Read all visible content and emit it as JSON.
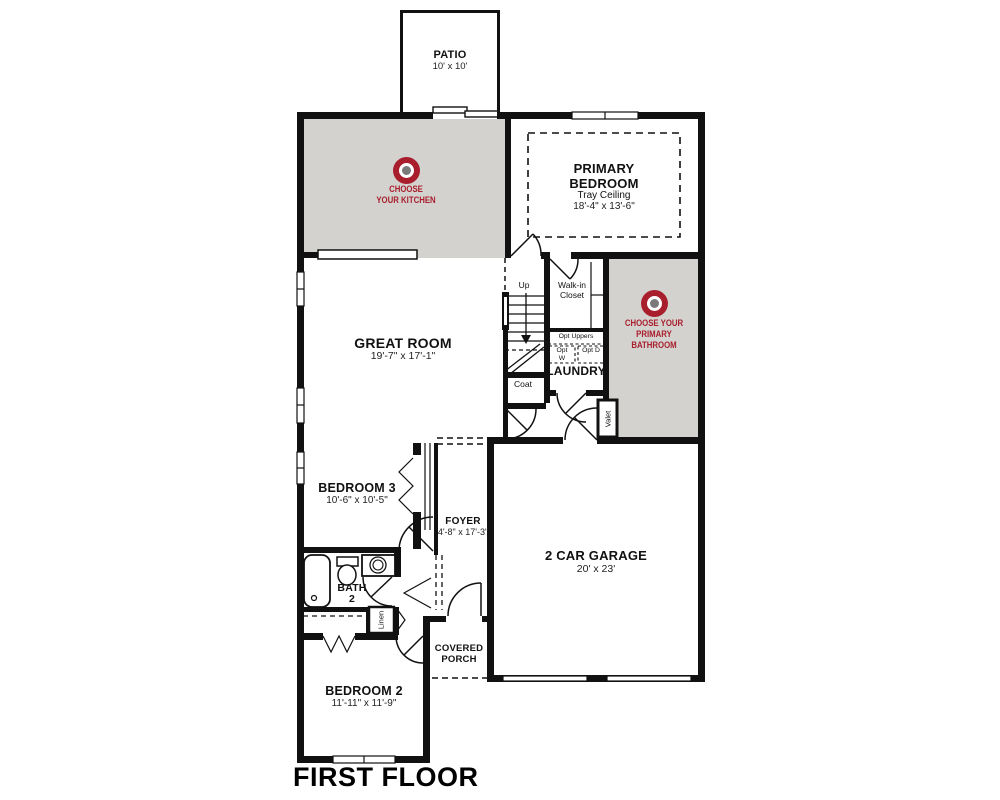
{
  "plan": {
    "floor_label": "FIRST FLOOR",
    "rooms": {
      "patio": {
        "name": "PATIO",
        "dims": "10' x 10'"
      },
      "primary_bedroom": {
        "name": "PRIMARY BEDROOM",
        "note": "Tray Ceiling",
        "dims": "18'-4\" x 13'-6\""
      },
      "great_room": {
        "name": "GREAT ROOM",
        "dims": "19'-7\" x 17'-1\""
      },
      "walk_in_closet": {
        "name": "Walk-in Closet"
      },
      "laundry": {
        "name": "LAUNDRY"
      },
      "bedroom3": {
        "name": "BEDROOM 3",
        "dims": "10'-6\" x 10'-5\""
      },
      "foyer": {
        "name": "FOYER",
        "dims": "4'-8\" x 17'-3\""
      },
      "bath2": {
        "line1": "BATH",
        "line2": "2"
      },
      "garage": {
        "name": "2 CAR GARAGE",
        "dims": "20' x 23'"
      },
      "bedroom2": {
        "name": "BEDROOM 2",
        "dims": "11'-11\" x 11'-9\""
      },
      "covered_porch": {
        "name": "COVERED PORCH"
      }
    },
    "small_labels": {
      "up": "Up",
      "coat": "Coat",
      "valet": "Valet",
      "linen": "Linen",
      "opt_uppers": "Opt Uppers",
      "opt_w": "Opt W",
      "opt_d": "Opt D"
    },
    "hotspots": {
      "kitchen": {
        "line1": "CHOOSE",
        "line2": "YOUR KITCHEN"
      },
      "primary_bath": {
        "line1": "CHOOSE YOUR",
        "line2": "PRIMARY",
        "line3": "BATHROOM"
      }
    },
    "colors": {
      "accent_red": "#a81e2d",
      "highlight_gray": "#d3d2ce",
      "wall_black": "#111111",
      "target_center_gray": "#7a7a7a"
    }
  }
}
